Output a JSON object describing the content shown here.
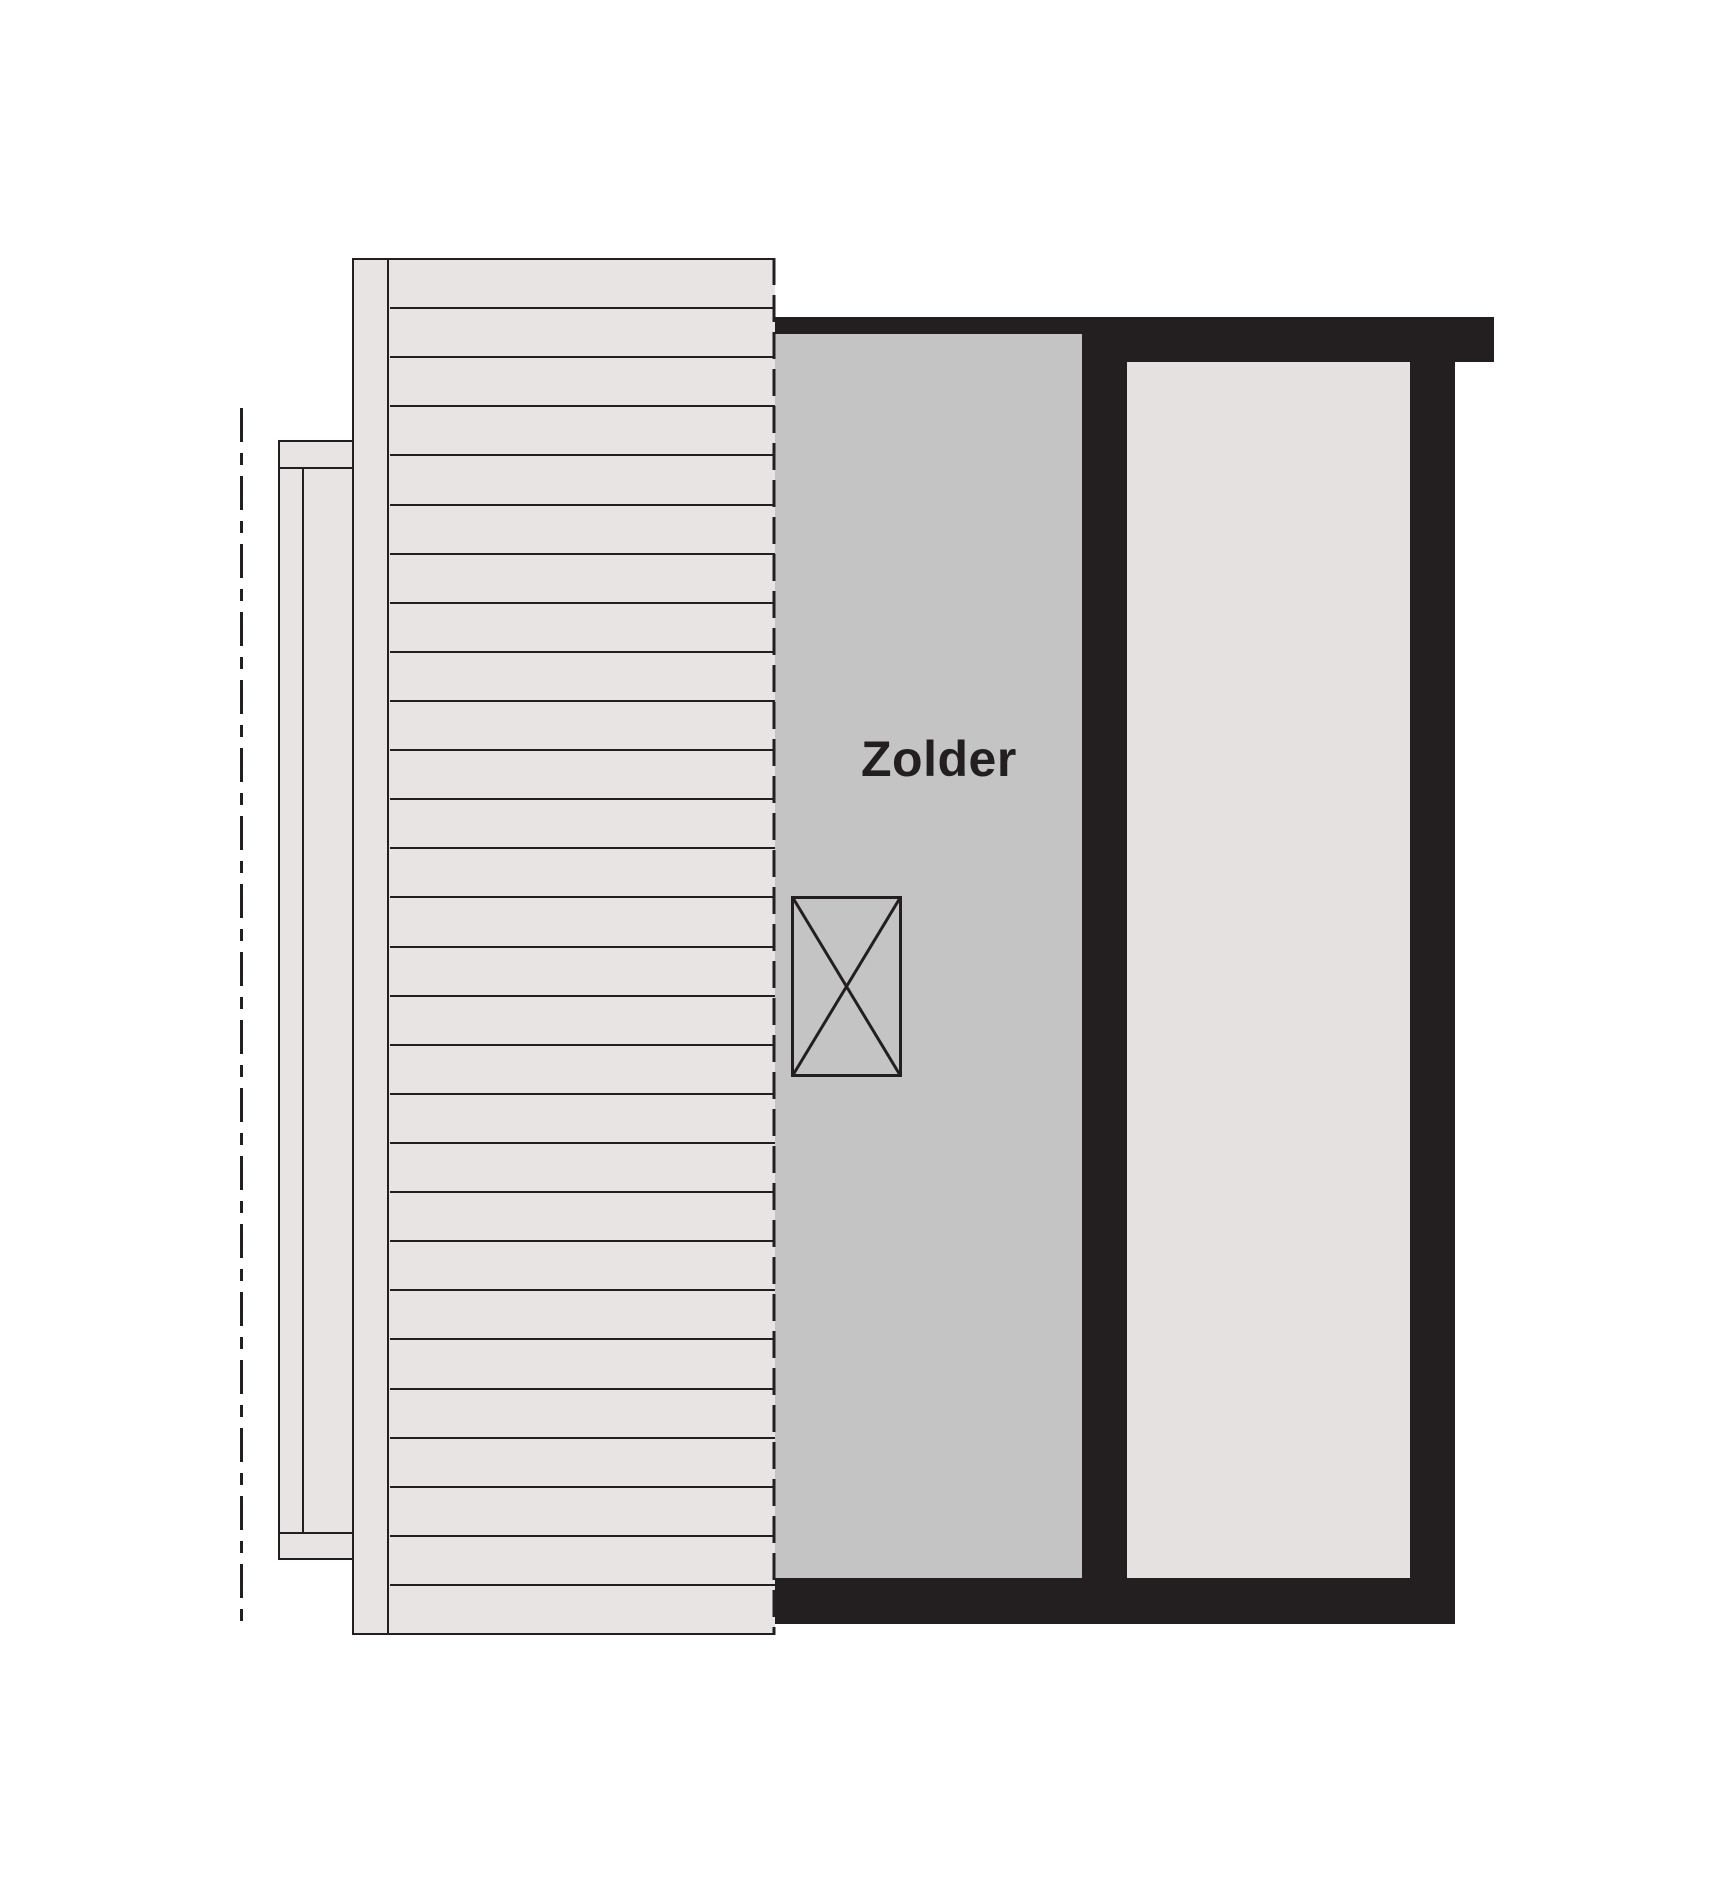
{
  "document": {
    "type": "floor-plan",
    "floor_label": "Zolder"
  },
  "rooms": {
    "zolder": {
      "label": "Zolder"
    },
    "secondary": {
      "label": ""
    }
  },
  "roof": {
    "plank_count": 28
  },
  "symbols": {
    "shaft_box": "crossed-box",
    "centerline": "dash-dot"
  },
  "colors": {
    "ink": "#231f20",
    "roof_fill": "#e7e4e3",
    "zolder_fill": "#c5c4c5",
    "room_fill": "#e4e1e0",
    "background": "#ffffff"
  }
}
